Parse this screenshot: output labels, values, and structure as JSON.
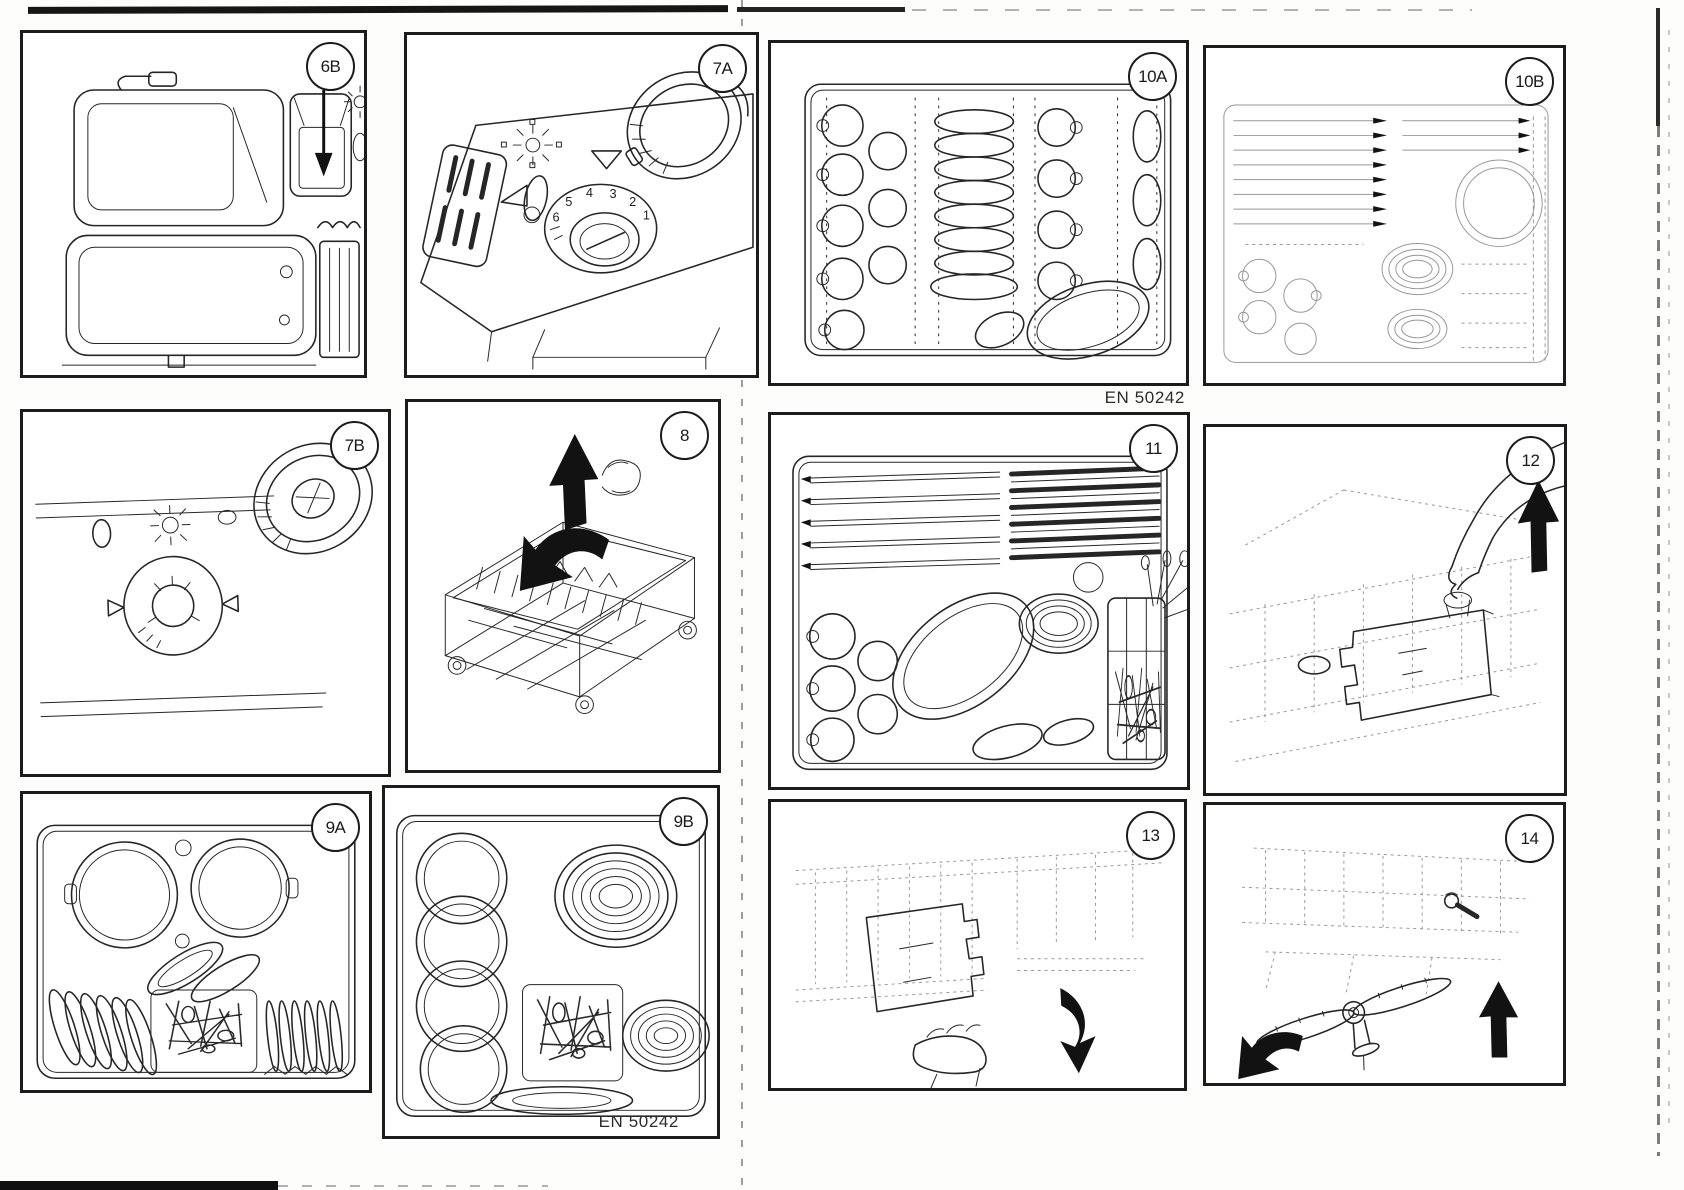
{
  "page": {
    "kind": "scanned dishwasher manual figures page",
    "ink_color": "#1c1c1c",
    "faint_ink_color": "#979797",
    "paper_color": "#fdfdfb"
  },
  "panels": [
    {
      "id": "6B",
      "badge": "6B",
      "label_h": "H"
    },
    {
      "id": "7A",
      "badge": "7A",
      "dial": [
        "6",
        "5",
        "4",
        "3",
        "2",
        "1"
      ]
    },
    {
      "id": "7B",
      "badge": "7B"
    },
    {
      "id": "8",
      "badge": "8"
    },
    {
      "id": "9A",
      "badge": "9A"
    },
    {
      "id": "9B",
      "badge": "9B",
      "caption": "EN 50242"
    },
    {
      "id": "10A",
      "badge": "10A",
      "caption": "EN 50242"
    },
    {
      "id": "10B",
      "badge": "10B"
    },
    {
      "id": "11",
      "badge": "11"
    },
    {
      "id": "12",
      "badge": "12"
    },
    {
      "id": "13",
      "badge": "13"
    },
    {
      "id": "14",
      "badge": "14"
    }
  ]
}
